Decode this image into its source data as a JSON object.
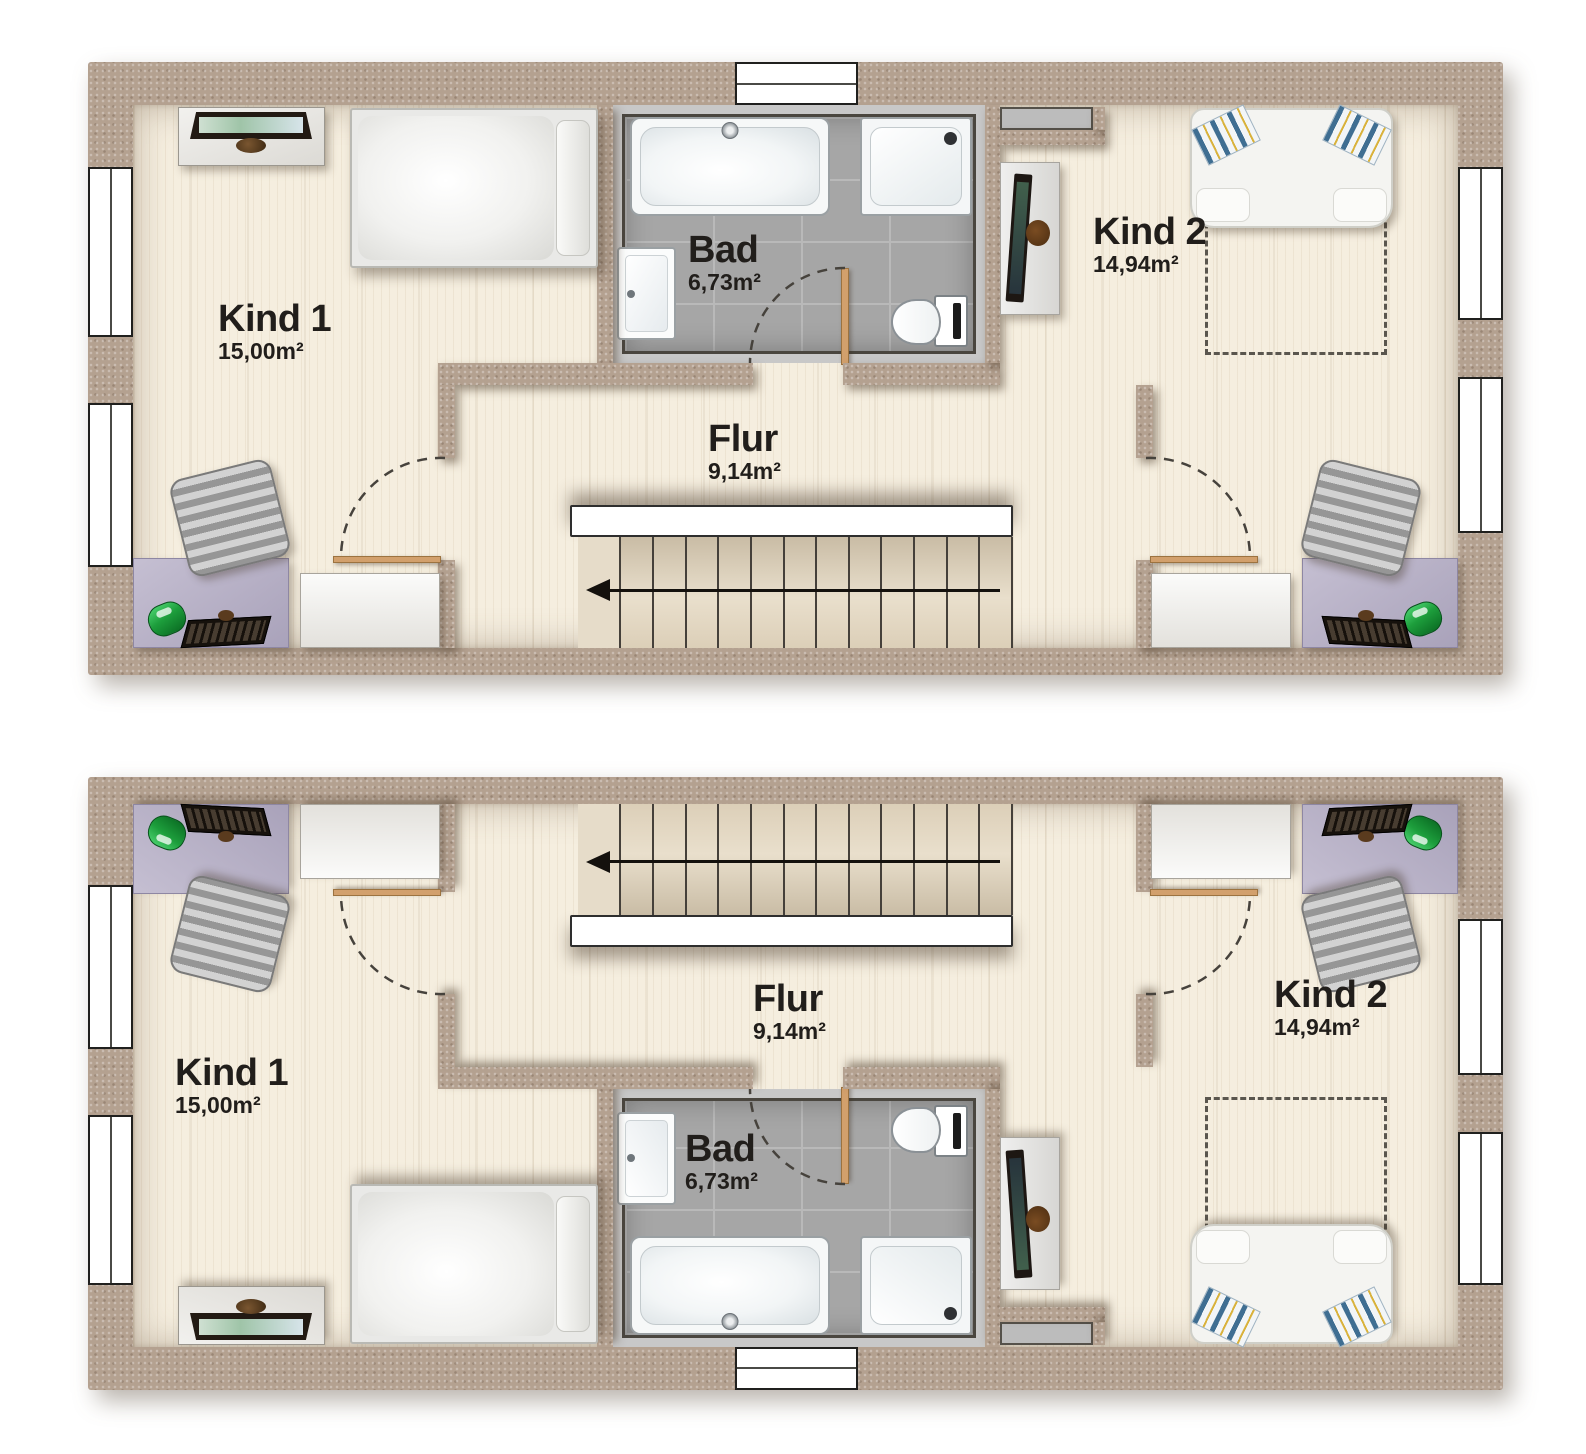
{
  "document": {
    "kind": "residential-floor-plan",
    "plan_count": 2,
    "note_arrow": "stair-direction-left"
  },
  "colors": {
    "wall": "#b4a190",
    "floor": "#f5eedf",
    "bath_tile": "#a6a6a6",
    "bath_surround": "#c8c8c8",
    "door_wood": "#d2a06c",
    "lamp_green": "#1d9e3c",
    "desk_lilac": "#b3abc4",
    "label_text": "#211e1b"
  },
  "plans": [
    {
      "id": "upper",
      "rooms": [
        {
          "name": "Kind 1",
          "area": "15,00m²"
        },
        {
          "name": "Bad",
          "area": "6,73m²"
        },
        {
          "name": "Flur",
          "area": "9,14m²"
        },
        {
          "name": "Kind 2",
          "area": "14,94m²"
        }
      ]
    },
    {
      "id": "lower",
      "rooms": [
        {
          "name": "Kind 1",
          "area": "15,00m²"
        },
        {
          "name": "Bad",
          "area": "6,73m²"
        },
        {
          "name": "Flur",
          "area": "9,14m²"
        },
        {
          "name": "Kind 2",
          "area": "14,94m²"
        }
      ]
    }
  ]
}
